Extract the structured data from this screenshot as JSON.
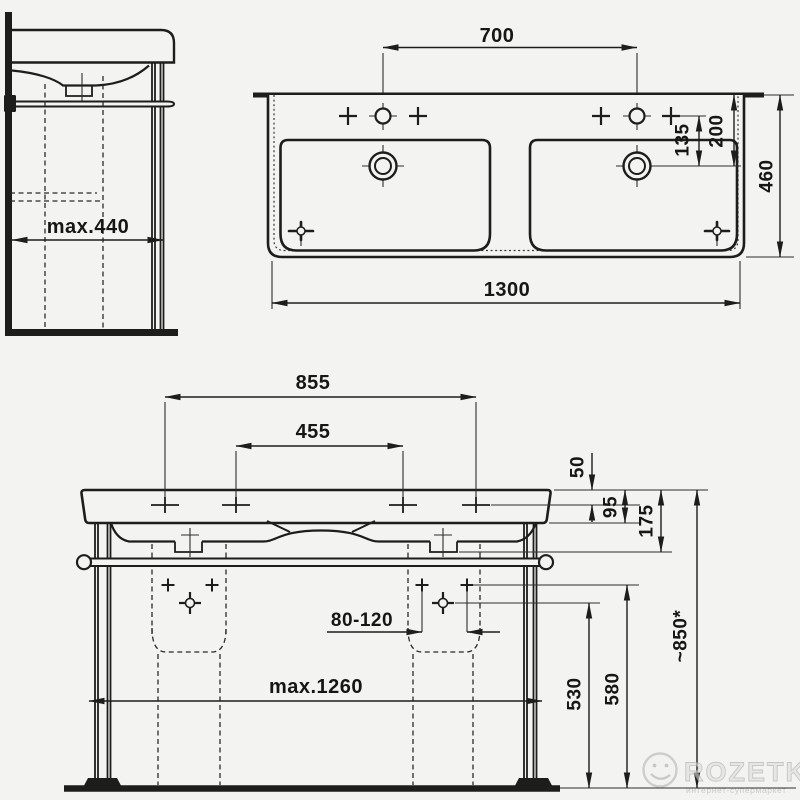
{
  "page": {
    "background_color": "#f3f3f1",
    "line_color": "#1d1d1b",
    "subject": "double-washbasin-with-frame-technical-drawing"
  },
  "side_view": {
    "title": "side-view",
    "dim_max_depth": "max.440"
  },
  "plan_view": {
    "title": "top-view",
    "dim_tap_spacing": "700",
    "dim_tap_to_drain": "135",
    "dim_back_to_drain": "200",
    "dim_depth": "460",
    "dim_width": "1300"
  },
  "front_view": {
    "title": "front-view",
    "dim_outer_holes": "855",
    "dim_inner_holes": "455",
    "dim_hole_offset": "50",
    "dim_apron_height": "95",
    "dim_total_height": "175",
    "dim_drain_range": "80-120",
    "dim_frame_width": "max.1260",
    "dim_supply_height": "530",
    "dim_connection_height": "580",
    "dim_install_height": "~850*"
  },
  "watermark": {
    "brand": "ROZETKA",
    "tagline": "интернет-супермаркет"
  }
}
